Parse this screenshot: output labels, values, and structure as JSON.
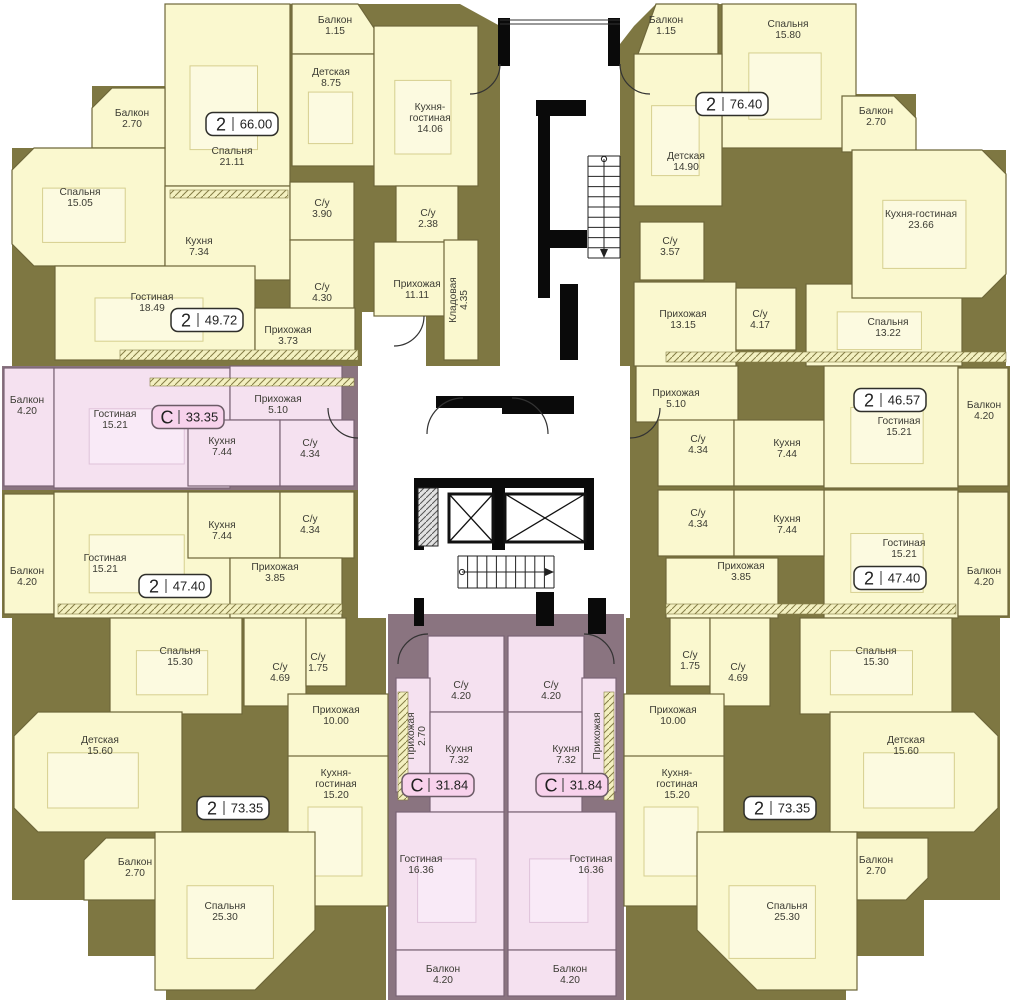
{
  "colors": {
    "olive": "#7E7742",
    "mauve": "#8A7480",
    "cream": "#FAF8CF",
    "pink": "#F5E1F0",
    "creamStroke": "#6E673A",
    "pinkStroke": "#7A6375",
    "furnCream": "#FCFAE0",
    "furnCreamStroke": "#D6CF8F",
    "furnPink": "#F9EAF7",
    "furnPinkStroke": "#DFC2DA",
    "text": "#3B3B33",
    "black": "#0A0A0A",
    "white": "#FFFFFF",
    "badge2Fill": "#FFFFFF",
    "badge2Stroke": "#2F2F2A",
    "badgeCFill": "#F8D2EC",
    "badgeCStroke": "#6B5B66"
  },
  "zones": [
    {
      "pts": "165,4 460,4 500,26 500,366 12,366 12,148 92,148 92,86 165,86",
      "f": "olive"
    },
    {
      "pts": "620,44 634,26 656,4 856,4 856,94 916,94 916,150 1006,150 1006,366 620,366",
      "f": "olive"
    },
    {
      "x": 2,
      "y": 366,
      "w": 356,
      "h": 124,
      "f": "mauve"
    },
    {
      "x": 2,
      "y": 490,
      "w": 356,
      "h": 128,
      "f": "olive"
    },
    {
      "pts": "12,618 386,618 386,1000 166,1000 166,956 88,956 88,900 12,900",
      "f": "olive"
    },
    {
      "x": 388,
      "y": 614,
      "w": 236,
      "h": 386,
      "f": "mauve"
    },
    {
      "pts": "806,282 962,282 962,366 1010,366 1010,490 630,490 630,366 806,366",
      "f": "olive"
    },
    {
      "x": 630,
      "y": 490,
      "w": 380,
      "h": 128,
      "f": "olive"
    },
    {
      "pts": "626,618 1000,618 1000,900 924,900 924,956 846,956 846,1000 626,1000",
      "f": "olive"
    }
  ],
  "whites": [
    {
      "x": 362,
      "y": 312,
      "w": 64,
      "h": 54
    }
  ],
  "rooms": [
    {
      "n": [
        "Спальня",
        "21.11"
      ],
      "x": 165,
      "y": 4,
      "w": 125,
      "h": 182,
      "lx": 232,
      "ly": 150,
      "f": "y",
      "furn": 1
    },
    {
      "n": [
        "Балкон",
        "1.15"
      ],
      "pts": "292,4 358,4 374,28 374,54 292,54",
      "x": 292,
      "y": 4,
      "w": 82,
      "h": 50,
      "lx": 335,
      "ly": 19,
      "f": "y"
    },
    {
      "n": [
        "Детская",
        "8.75"
      ],
      "x": 292,
      "y": 54,
      "w": 82,
      "h": 112,
      "lx": 331,
      "ly": 71,
      "f": "y",
      "furn": 1
    },
    {
      "n": [
        "Кухня-",
        "гостиная",
        "14.06"
      ],
      "x": 374,
      "y": 26,
      "w": 104,
      "h": 160,
      "lx": 430,
      "ly": 106,
      "f": "y",
      "furn": 1
    },
    {
      "n": [
        "Балкон",
        "2.70"
      ],
      "pts": "92,108 112,88 165,88 165,148 92,148",
      "x": 92,
      "y": 88,
      "w": 73,
      "h": 60,
      "lx": 132,
      "ly": 112,
      "f": "y"
    },
    {
      "n": [
        "Спальня",
        "15.05"
      ],
      "pts": "12,170 34,148 165,148 165,266 34,266 12,244",
      "x": 12,
      "y": 148,
      "w": 153,
      "h": 118,
      "lx": 80,
      "ly": 191,
      "f": "y",
      "furn": 1
    },
    {
      "n": [
        "Кухня",
        "7.34"
      ],
      "x": 165,
      "y": 186,
      "w": 125,
      "h": 94,
      "lx": 199,
      "ly": 240,
      "f": "y"
    },
    {
      "n": [
        "С/у",
        "3.90"
      ],
      "x": 290,
      "y": 182,
      "w": 64,
      "h": 58,
      "lx": 322,
      "ly": 202,
      "f": "y"
    },
    {
      "n": [
        "С/у",
        "2.38"
      ],
      "x": 396,
      "y": 186,
      "w": 62,
      "h": 56,
      "lx": 428,
      "ly": 212,
      "f": "y"
    },
    {
      "n": [
        "С/у",
        "4.30"
      ],
      "x": 290,
      "y": 240,
      "w": 64,
      "h": 70,
      "lx": 322,
      "ly": 286,
      "f": "y"
    },
    {
      "n": [
        "Гостиная",
        "18.49"
      ],
      "x": 55,
      "y": 266,
      "w": 200,
      "h": 94,
      "lx": 152,
      "ly": 296,
      "f": "y",
      "furn": 1
    },
    {
      "n": [
        "Прихожая",
        "11.11"
      ],
      "x": 374,
      "y": 242,
      "w": 88,
      "h": 74,
      "lx": 417,
      "ly": 283,
      "f": "y"
    },
    {
      "n": [
        "Кладовая",
        "4.35"
      ],
      "x": 444,
      "y": 240,
      "w": 34,
      "h": 120,
      "lx": 452,
      "ly": 300,
      "f": "y",
      "rot": 1
    },
    {
      "n": [
        "Прихожая",
        "3.73"
      ],
      "x": 255,
      "y": 308,
      "w": 100,
      "h": 52,
      "lx": 288,
      "ly": 329,
      "f": "y"
    },
    {
      "n": [
        "Балкон",
        "4.20"
      ],
      "x": 4,
      "y": 368,
      "w": 50,
      "h": 118,
      "lx": 27,
      "ly": 399,
      "f": "p"
    },
    {
      "n": [
        "Гостиная",
        "15.21"
      ],
      "x": 54,
      "y": 368,
      "w": 176,
      "h": 120,
      "lx": 115,
      "ly": 413,
      "f": "p",
      "furn": 1
    },
    {
      "n": [
        "Прихожая",
        "5.10"
      ],
      "x": 230,
      "y": 366,
      "w": 112,
      "h": 54,
      "lx": 278,
      "ly": 398,
      "f": "p"
    },
    {
      "n": [
        "Кухня",
        "7.44"
      ],
      "x": 188,
      "y": 420,
      "w": 92,
      "h": 66,
      "lx": 222,
      "ly": 440,
      "f": "p"
    },
    {
      "n": [
        "С/у",
        "4.34"
      ],
      "x": 280,
      "y": 420,
      "w": 74,
      "h": 66,
      "lx": 310,
      "ly": 442,
      "f": "p"
    },
    {
      "n": [
        "Балкон",
        "4.20"
      ],
      "x": 4,
      "y": 494,
      "w": 50,
      "h": 120,
      "lx": 27,
      "ly": 570,
      "f": "y"
    },
    {
      "n": [
        "Гостиная",
        "15.21"
      ],
      "x": 54,
      "y": 492,
      "w": 176,
      "h": 126,
      "lx": 105,
      "ly": 557,
      "f": "y",
      "furn": 1
    },
    {
      "n": [
        "Кухня",
        "7.44"
      ],
      "x": 188,
      "y": 492,
      "w": 92,
      "h": 66,
      "lx": 222,
      "ly": 524,
      "f": "y"
    },
    {
      "n": [
        "С/у",
        "4.34"
      ],
      "x": 280,
      "y": 492,
      "w": 74,
      "h": 66,
      "lx": 310,
      "ly": 518,
      "f": "y"
    },
    {
      "n": [
        "Прихожая",
        "3.85"
      ],
      "x": 230,
      "y": 558,
      "w": 112,
      "h": 60,
      "lx": 275,
      "ly": 566,
      "f": "y"
    },
    {
      "n": [
        "Спальня",
        "15.30"
      ],
      "x": 110,
      "y": 618,
      "w": 132,
      "h": 96,
      "lx": 180,
      "ly": 650,
      "f": "y",
      "furn": 1
    },
    {
      "n": [
        "С/у",
        "4.69"
      ],
      "x": 244,
      "y": 618,
      "w": 62,
      "h": 88,
      "lx": 280,
      "ly": 666,
      "f": "y"
    },
    {
      "n": [
        "С/у",
        "1.75"
      ],
      "x": 306,
      "y": 618,
      "w": 40,
      "h": 68,
      "lx": 318,
      "ly": 656,
      "f": "y"
    },
    {
      "n": [
        "Прихожая",
        "10.00"
      ],
      "x": 288,
      "y": 694,
      "w": 100,
      "h": 76,
      "lx": 336,
      "ly": 709,
      "f": "y"
    },
    {
      "n": [
        "Детская",
        "15.60"
      ],
      "pts": "14,736 38,712 182,712 182,832 38,832 14,808",
      "x": 14,
      "y": 712,
      "w": 168,
      "h": 120,
      "lx": 100,
      "ly": 739,
      "f": "y",
      "furn": 1
    },
    {
      "n": [
        "Балкон",
        "2.70"
      ],
      "pts": "84,860 106,838 176,838 176,900 84,900",
      "x": 84,
      "y": 838,
      "w": 92,
      "h": 62,
      "lx": 135,
      "ly": 861,
      "f": "y"
    },
    {
      "n": [
        "Кухня-",
        "гостиная",
        "15.20"
      ],
      "x": 288,
      "y": 756,
      "w": 100,
      "h": 150,
      "lx": 336,
      "ly": 772,
      "f": "y",
      "furn": 1
    },
    {
      "n": [
        "Спальня",
        "25.30"
      ],
      "pts": "155,832 315,832 315,930 255,990 155,990",
      "x": 155,
      "y": 832,
      "w": 160,
      "h": 158,
      "lx": 225,
      "ly": 905,
      "f": "y",
      "furn": 1
    },
    {
      "n": [
        "С/у",
        "4.20"
      ],
      "x": 428,
      "y": 636,
      "w": 76,
      "h": 76,
      "lx": 461,
      "ly": 684,
      "f": "p"
    },
    {
      "n": [
        "Прихожая",
        "2.70"
      ],
      "x": 396,
      "y": 678,
      "w": 34,
      "h": 114,
      "lx": 410,
      "ly": 736,
      "f": "p",
      "rot": 1
    },
    {
      "n": [
        "Кухня",
        "7.32"
      ],
      "x": 430,
      "y": 712,
      "w": 74,
      "h": 100,
      "lx": 459,
      "ly": 748,
      "f": "p"
    },
    {
      "n": [
        "Гостиная",
        "16.36"
      ],
      "x": 396,
      "y": 812,
      "w": 108,
      "h": 138,
      "lx": 421,
      "ly": 858,
      "f": "p",
      "furn": 1
    },
    {
      "n": [
        "Балкон",
        "4.20"
      ],
      "x": 396,
      "y": 950,
      "w": 108,
      "h": 46,
      "lx": 443,
      "ly": 968,
      "f": "p"
    },
    {
      "n": [
        "С/у",
        "4.20"
      ],
      "x": 508,
      "y": 636,
      "w": 76,
      "h": 76,
      "lx": 551,
      "ly": 684,
      "f": "p"
    },
    {
      "n": [
        "Прихожая",
        "2.70"
      ],
      "x": 582,
      "y": 678,
      "w": 34,
      "h": 114,
      "lx": 596,
      "ly": 736,
      "f": "p",
      "rot": 1
    },
    {
      "n": [
        "Кухня",
        "7.32"
      ],
      "x": 508,
      "y": 712,
      "w": 74,
      "h": 100,
      "lx": 566,
      "ly": 748,
      "f": "p"
    },
    {
      "n": [
        "Гостиная",
        "16.36"
      ],
      "x": 508,
      "y": 812,
      "w": 108,
      "h": 138,
      "lx": 591,
      "ly": 858,
      "f": "p",
      "furn": 1
    },
    {
      "n": [
        "Балкон",
        "4.20"
      ],
      "x": 508,
      "y": 950,
      "w": 108,
      "h": 46,
      "lx": 570,
      "ly": 968,
      "f": "p"
    },
    {
      "n": [
        "Спальня",
        "13.22"
      ],
      "x": 806,
      "y": 284,
      "w": 156,
      "h": 82,
      "lx": 888,
      "ly": 321,
      "f": "y",
      "furn": 1
    },
    {
      "n": [
        "Прихожая",
        "5.10"
      ],
      "x": 636,
      "y": 366,
      "w": 102,
      "h": 56,
      "lx": 676,
      "ly": 392,
      "f": "y"
    },
    {
      "n": [
        "С/у",
        "4.34"
      ],
      "x": 658,
      "y": 420,
      "w": 76,
      "h": 66,
      "lx": 698,
      "ly": 438,
      "f": "y"
    },
    {
      "n": [
        "Кухня",
        "7.44"
      ],
      "x": 734,
      "y": 420,
      "w": 90,
      "h": 66,
      "lx": 787,
      "ly": 442,
      "f": "y"
    },
    {
      "n": [
        "Гостиная",
        "15.21"
      ],
      "x": 824,
      "y": 366,
      "w": 134,
      "h": 122,
      "lx": 899,
      "ly": 420,
      "f": "y",
      "furn": 1
    },
    {
      "n": [
        "Балкон",
        "4.20"
      ],
      "x": 958,
      "y": 368,
      "w": 50,
      "h": 118,
      "lx": 984,
      "ly": 404,
      "f": "y"
    },
    {
      "n": [
        "Гостиная",
        "15.21"
      ],
      "x": 824,
      "y": 490,
      "w": 134,
      "h": 128,
      "lx": 904,
      "ly": 542,
      "f": "y",
      "furn": 1
    },
    {
      "n": [
        "С/у",
        "4.34"
      ],
      "x": 658,
      "y": 490,
      "w": 76,
      "h": 66,
      "lx": 698,
      "ly": 512,
      "f": "y"
    },
    {
      "n": [
        "Кухня",
        "7.44"
      ],
      "x": 734,
      "y": 490,
      "w": 90,
      "h": 66,
      "lx": 787,
      "ly": 518,
      "f": "y"
    },
    {
      "n": [
        "Прихожая",
        "3.85"
      ],
      "x": 666,
      "y": 558,
      "w": 112,
      "h": 60,
      "lx": 741,
      "ly": 565,
      "f": "y"
    },
    {
      "n": [
        "Балкон",
        "4.20"
      ],
      "x": 958,
      "y": 492,
      "w": 50,
      "h": 124,
      "lx": 984,
      "ly": 570,
      "f": "y"
    },
    {
      "n": [
        "Балкон",
        "1.15"
      ],
      "pts": "656,4 718,4 718,54 638,54",
      "x": 638,
      "y": 4,
      "w": 80,
      "h": 50,
      "lx": 666,
      "ly": 19,
      "f": "y"
    },
    {
      "n": [
        "Спальня",
        "15.80"
      ],
      "x": 722,
      "y": 4,
      "w": 134,
      "h": 144,
      "lx": 788,
      "ly": 23,
      "f": "y",
      "furn": 1
    },
    {
      "n": [
        "Детская",
        "14.90"
      ],
      "x": 634,
      "y": 54,
      "w": 88,
      "h": 152,
      "lx": 686,
      "ly": 155,
      "f": "y",
      "furn": 1
    },
    {
      "n": [
        "Балкон",
        "2.70"
      ],
      "pts": "842,96 894,96 916,118 916,152 842,152",
      "x": 842,
      "y": 96,
      "w": 74,
      "h": 56,
      "lx": 876,
      "ly": 110,
      "f": "y"
    },
    {
      "n": [
        "Кухня-гостиная",
        "23.66"
      ],
      "pts": "852,150 982,150 1006,174 1006,274 982,298 852,298",
      "x": 852,
      "y": 150,
      "w": 154,
      "h": 148,
      "lx": 921,
      "ly": 213,
      "f": "y",
      "furn": 1
    },
    {
      "n": [
        "С/у",
        "3.57"
      ],
      "x": 640,
      "y": 222,
      "w": 64,
      "h": 58,
      "lx": 670,
      "ly": 240,
      "f": "y"
    },
    {
      "n": [
        "Прихожая",
        "13.15"
      ],
      "x": 634,
      "y": 282,
      "w": 102,
      "h": 84,
      "lx": 683,
      "ly": 313,
      "f": "y"
    },
    {
      "n": [
        "С/у",
        "4.17"
      ],
      "x": 736,
      "y": 288,
      "w": 60,
      "h": 62,
      "lx": 760,
      "ly": 313,
      "f": "y"
    },
    {
      "n": [
        "С/у",
        "1.75"
      ],
      "x": 670,
      "y": 618,
      "w": 40,
      "h": 68,
      "lx": 690,
      "ly": 654,
      "f": "y"
    },
    {
      "n": [
        "С/у",
        "4.69"
      ],
      "x": 710,
      "y": 618,
      "w": 60,
      "h": 88,
      "lx": 738,
      "ly": 666,
      "f": "y"
    },
    {
      "n": [
        "Спальня",
        "15.30"
      ],
      "x": 800,
      "y": 618,
      "w": 152,
      "h": 96,
      "lx": 876,
      "ly": 650,
      "f": "y",
      "furn": 1
    },
    {
      "n": [
        "Прихожая",
        "10.00"
      ],
      "x": 624,
      "y": 694,
      "w": 100,
      "h": 76,
      "lx": 673,
      "ly": 709,
      "f": "y"
    },
    {
      "n": [
        "Кухня-",
        "гостиная",
        "15.20"
      ],
      "x": 624,
      "y": 756,
      "w": 100,
      "h": 150,
      "lx": 677,
      "ly": 772,
      "f": "y",
      "furn": 1
    },
    {
      "n": [
        "Детская",
        "15.60"
      ],
      "pts": "830,712 974,712 998,736 998,808 974,832 830,832",
      "x": 830,
      "y": 712,
      "w": 168,
      "h": 120,
      "lx": 906,
      "ly": 739,
      "f": "y",
      "furn": 1
    },
    {
      "n": [
        "Балкон",
        "2.70"
      ],
      "pts": "836,838 928,838 928,878 906,900 836,900",
      "x": 836,
      "y": 838,
      "w": 92,
      "h": 62,
      "lx": 876,
      "ly": 859,
      "f": "y"
    },
    {
      "n": [
        "Спальня",
        "25.30"
      ],
      "pts": "697,832 857,832 857,990 757,990 697,930",
      "x": 697,
      "y": 832,
      "w": 160,
      "h": 158,
      "lx": 787,
      "ly": 905,
      "f": "y",
      "furn": 1
    }
  ],
  "badges": [
    {
      "t": "2",
      "v": "66.00",
      "x": 242,
      "y": 124
    },
    {
      "t": "2",
      "v": "49.72",
      "x": 207,
      "y": 320
    },
    {
      "t": "C",
      "v": "33.35",
      "x": 188,
      "y": 417
    },
    {
      "t": "2",
      "v": "47.40",
      "x": 175,
      "y": 586
    },
    {
      "t": "2",
      "v": "73.35",
      "x": 233,
      "y": 808
    },
    {
      "t": "C",
      "v": "31.84",
      "x": 438,
      "y": 785
    },
    {
      "t": "C",
      "v": "31.84",
      "x": 572,
      "y": 785
    },
    {
      "t": "2",
      "v": "73.35",
      "x": 780,
      "y": 808
    },
    {
      "t": "2",
      "v": "47.40",
      "x": 890,
      "y": 578
    },
    {
      "t": "2",
      "v": "46.57",
      "x": 890,
      "y": 400
    },
    {
      "t": "2",
      "v": "76.40",
      "x": 732,
      "y": 104
    }
  ],
  "core": {
    "black": [
      [
        498,
        18,
        12,
        48
      ],
      [
        608,
        18,
        12,
        48
      ],
      [
        536,
        100,
        50,
        16
      ],
      [
        538,
        116,
        12,
        182
      ],
      [
        545,
        230,
        42,
        18
      ],
      [
        560,
        284,
        18,
        76
      ],
      [
        436,
        396,
        66,
        12
      ],
      [
        502,
        396,
        72,
        18
      ],
      [
        414,
        478,
        180,
        10
      ],
      [
        414,
        486,
        10,
        64
      ],
      [
        492,
        486,
        13,
        64
      ],
      [
        584,
        486,
        10,
        64
      ],
      [
        536,
        592,
        18,
        34
      ],
      [
        414,
        598,
        10,
        28
      ],
      [
        588,
        598,
        18,
        36
      ]
    ],
    "shaft": [
      418,
      488,
      20,
      58
    ],
    "elevators": [
      [
        449,
        494,
        44,
        48
      ],
      [
        505,
        494,
        80,
        48
      ]
    ],
    "stairs": [
      {
        "x": 588,
        "y": 156,
        "w": 32,
        "h": 102,
        "n": 11,
        "dir": "v"
      },
      {
        "x": 458,
        "y": 556,
        "w": 96,
        "h": 32,
        "n": 11,
        "dir": "h"
      }
    ],
    "arcs": [
      "M500,64 A30,30 0 0 1 470,94",
      "M620,64 A30,30 0 0 0 650,94",
      "M463,398 A36,36 0 0 0 427,434",
      "M512,398 A36,36 0 0 1 548,434",
      "M424,316 A30,30 0 0 1 394,346",
      "M428,634 A30,30 0 0 0 398,664",
      "M584,634 A30,30 0 0 1 614,664",
      "M358,438 A30,30 0 0 1 328,408",
      "M630,438 A30,30 0 0 0 660,408"
    ],
    "lines": [
      [
        500,
        20,
        620,
        20
      ],
      [
        500,
        24,
        620,
        24
      ]
    ],
    "hatch": [
      [
        170,
        190,
        118,
        8
      ],
      [
        120,
        350,
        238,
        10
      ],
      [
        150,
        378,
        204,
        8
      ],
      [
        58,
        604,
        284,
        10
      ],
      [
        666,
        604,
        290,
        10
      ],
      [
        666,
        352,
        340,
        10
      ],
      [
        398,
        692,
        10,
        108
      ],
      [
        604,
        692,
        10,
        108
      ]
    ]
  }
}
